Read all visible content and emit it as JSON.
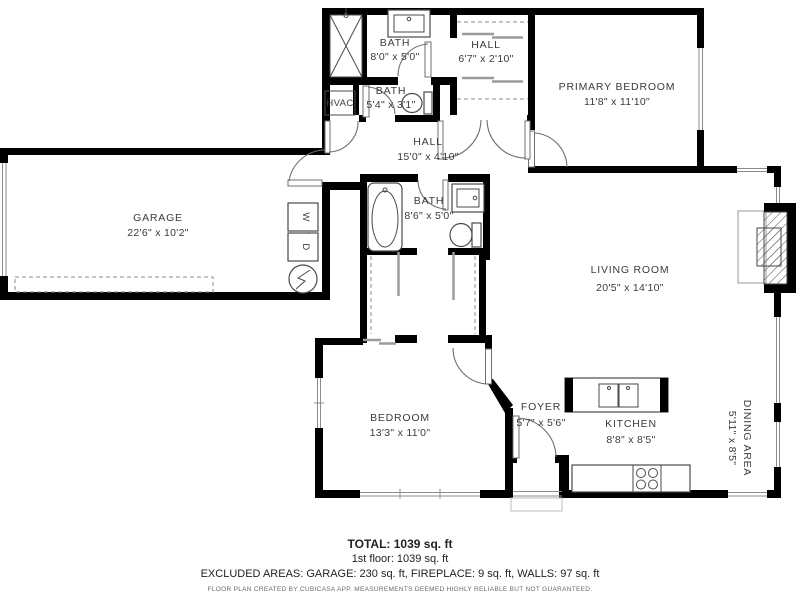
{
  "colors": {
    "wall": "#000000",
    "label": "#3b3b3b",
    "fixture_line": "#4a4a4a",
    "window_line": "#8c8c8c",
    "dashed_line": "#8a8a8a"
  },
  "rooms": {
    "bath_top": {
      "name": "BATH",
      "dims": "8'0\" x 5'0\""
    },
    "hall_closet": {
      "name": "HALL",
      "dims": "6'7\" x 2'10\""
    },
    "primary_bedroom": {
      "name": "PRIMARY BEDROOM",
      "dims": "11'8\" x 11'10\""
    },
    "hvac": {
      "name": "HVAC"
    },
    "bath_powder": {
      "name": "BATH",
      "dims": "5'4\" x 3'1\""
    },
    "hall_main": {
      "name": "HALL",
      "dims": "15'0\" x 4'10\""
    },
    "garage": {
      "name": "GARAGE",
      "dims": "22'6\" x 10'2\""
    },
    "bath_middle": {
      "name": "BATH",
      "dims": "8'6\" x 5'0\""
    },
    "living_room": {
      "name": "LIVING ROOM",
      "dims": "20'5\" x 14'10\""
    },
    "bedroom": {
      "name": "BEDROOM",
      "dims": "13'3\" x 11'0\""
    },
    "foyer": {
      "name": "FOYER",
      "dims": "5'7\" x 5'6\""
    },
    "kitchen": {
      "name": "KITCHEN",
      "dims": "8'8\" x 8'5\""
    },
    "dining_area": {
      "name": "DINING AREA",
      "dims": "5'11\" x 8'5\""
    }
  },
  "appliances": {
    "washer_label": "W",
    "dryer_label": "D"
  },
  "footer": {
    "total": "TOTAL: 1039 sq. ft",
    "floor1": "1st floor: 1039 sq. ft",
    "excluded": "EXCLUDED AREAS: GARAGE: 230 sq. ft, FIREPLACE: 9 sq. ft, WALLS: 97 sq. ft",
    "disclaimer": "FLOOR PLAN CREATED BY CUBICASA APP. MEASUREMENTS DEEMED HIGHLY RELIABLE BUT NOT GUARANTEED."
  }
}
